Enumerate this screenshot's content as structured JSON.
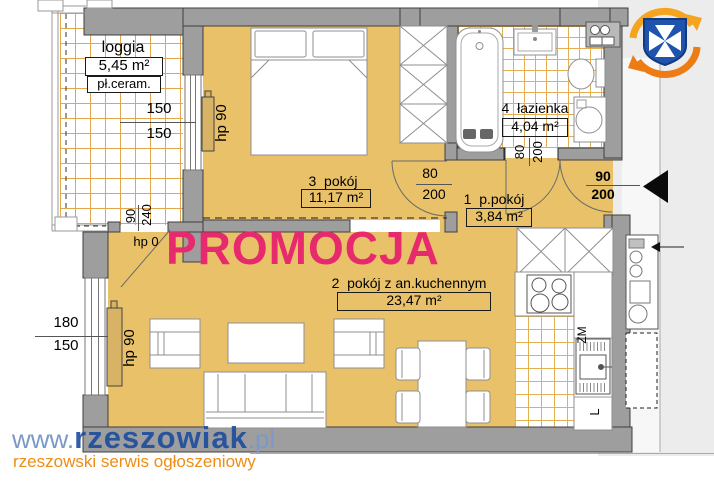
{
  "rooms": {
    "loggia": {
      "name": "loggia",
      "area": "5,45 m²",
      "floor": "pł.ceram."
    },
    "room3": {
      "name": "3  pokój",
      "area": "11,17 m²"
    },
    "bathroom": {
      "name": "4  łazienka",
      "area": "4,04 m²"
    },
    "hall": {
      "name": "1  p.pokój",
      "area": "3,84 m²"
    },
    "room2": {
      "name": "2  pokój z an.kuchennym",
      "area": "23,47 m²"
    }
  },
  "promo": {
    "label": "PROMOCJA",
    "color": "#e62a6d"
  },
  "dims": {
    "loggia_window_top": "150",
    "loggia_window_bottom": "150",
    "room2_window_top": "180",
    "room2_window_bottom": "150",
    "balcony_door_width": "90",
    "balcony_door_height": "240",
    "balcony_door_hp": "hp 0",
    "room3_radiator": "hp 90",
    "room2_radiator": "hp 90",
    "room3_door_width": "80",
    "room3_door_height": "200",
    "bathroom_door_width": "80",
    "bathroom_door_height": "200",
    "entrance_door_width": "90",
    "entrance_door_height": "200"
  },
  "kitchen": {
    "sink": "ZM",
    "fridge": "L"
  },
  "watermark": {
    "prefix": "www.",
    "brand": "rzeszowiak",
    "tld": ".pl",
    "tagline": "rzeszowski serwis ogłoszeniowy"
  },
  "colors": {
    "floor": "#e9c169",
    "wall": "#9e9e9e",
    "tile_line": "#e2a74d",
    "corridor": "#ececec",
    "promo": "#e62a6d",
    "brand_blue": "#1c4c9f",
    "brand_light_blue": "#7b99c6",
    "brand_orange": "#ee8d15",
    "logo_blue": "#2053ad",
    "logo_orange": "#f6a41f"
  }
}
